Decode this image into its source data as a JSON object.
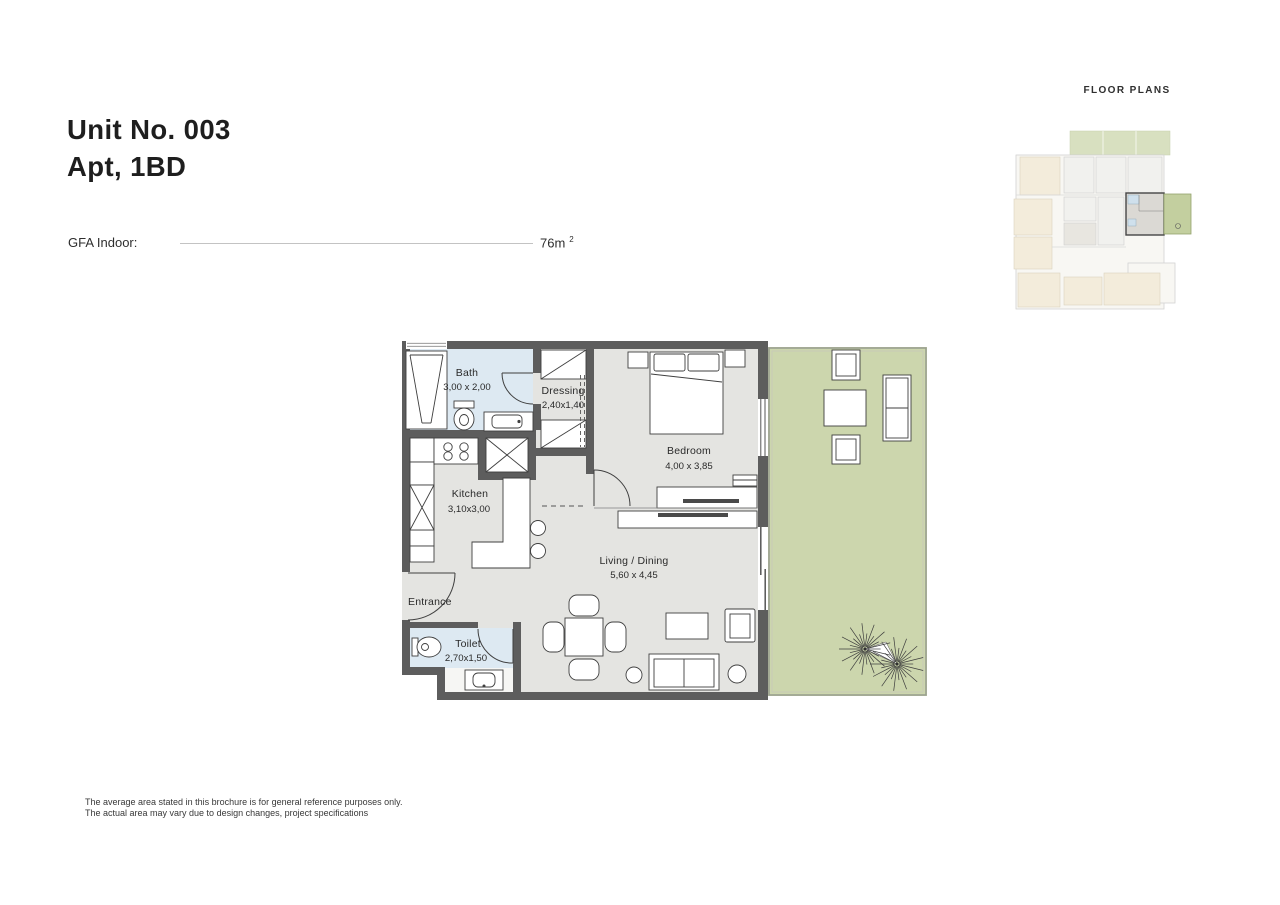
{
  "document": {
    "section_label": "FLOOR PLANS",
    "title_line1": "Unit No. 003",
    "title_line2": "Apt, 1BD",
    "gfa_label": "GFA Indoor:",
    "gfa_value": "76m",
    "gfa_unit_exponent": "2",
    "disclaimer_line1": "The average area stated in this brochure is for general reference purposes only.",
    "disclaimer_line2": "The actual area may vary due to design changes, project specifications"
  },
  "floor_plan": {
    "rooms": [
      {
        "name": "Bath",
        "dimensions": "3,00 x 2,00"
      },
      {
        "name": "Dressing",
        "dimensions": "2,40x1,40"
      },
      {
        "name": "Bedroom",
        "dimensions": "4,00 x 3,85"
      },
      {
        "name": "Kitchen",
        "dimensions": "3,10x3,00"
      },
      {
        "name": "Living / Dining",
        "dimensions": "5,60 x 4,45"
      },
      {
        "name": "Entrance",
        "dimensions": ""
      },
      {
        "name": "Toilet",
        "dimensions": "2,70x1,50"
      }
    ],
    "colors": {
      "wall": "#5d5d5d",
      "floor": "#e4e4e1",
      "wet_area_floor": "#dde9f2",
      "terrace": "#ccd6ad",
      "page_background": "#ffffff"
    }
  }
}
